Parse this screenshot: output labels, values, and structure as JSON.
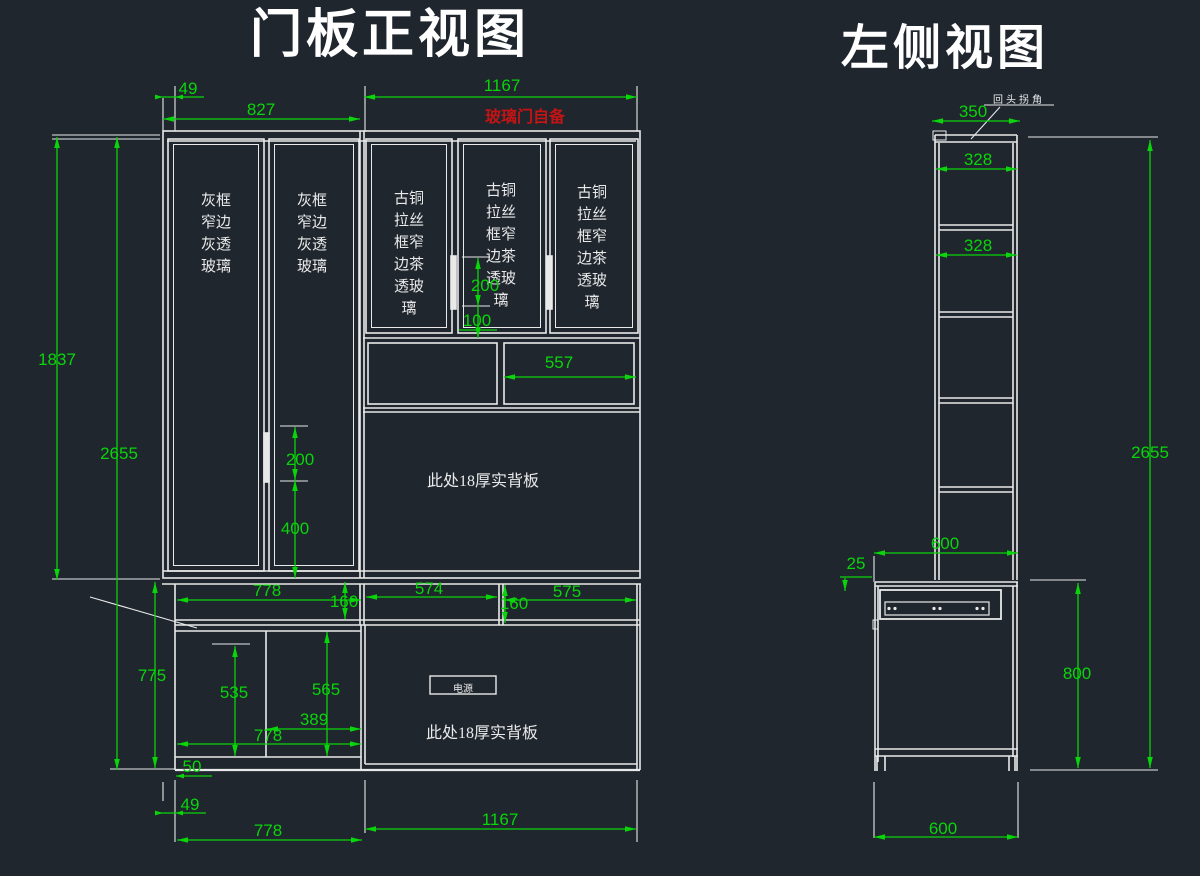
{
  "app": {
    "background_color": "#1f262e",
    "line_color": "#e9e9e9",
    "dimension_color": "#0ad40a",
    "warning_color": "#c21414"
  },
  "front_view": {
    "title": "门板正视图",
    "glass_note_red": "玻璃门自备",
    "door_gray_label": "灰框\n窄边\n灰透\n玻璃",
    "door_bronze_label": "古铜\n拉丝\n框窄\n边茶\n透玻\n璃",
    "upper_back_panel_note": "此处18厚实背板",
    "lower_back_panel_note": "此处18厚实背板",
    "power_outlet_label": "电源",
    "dims": {
      "top_offset": "49",
      "top_left_width": "827",
      "top_right_width": "1167",
      "upper_height": "1837",
      "total_height": "2655",
      "mid_handle_length": "200",
      "mid_handle_bottom_offset": "100",
      "left_handle_length": "200",
      "left_handle_height": "400",
      "shelf_width": "557",
      "drawer_left_width": "778",
      "drawer_height_left": "160",
      "drawer_mid_width": "574",
      "drawer_height_right": "160",
      "drawer_right_width": "575",
      "base_height": "775",
      "compartment_left_height": "535",
      "compartment_right_height": "565",
      "compartment_right_width": "389",
      "base_left_inner_width": "778",
      "kick_height": "50",
      "bottom_offset": "49",
      "bottom_left_width": "778",
      "bottom_right_width": "1167"
    }
  },
  "side_view": {
    "title": "左侧视图",
    "corner_note": "回头拐角",
    "dims": {
      "top_depth": "350",
      "shelf_depth_upper": "328",
      "shelf_depth_lower": "328",
      "base_depth_top": "600",
      "counter_overhang": "25",
      "base_height": "800",
      "total_height": "2655",
      "base_depth_bottom": "600"
    }
  }
}
